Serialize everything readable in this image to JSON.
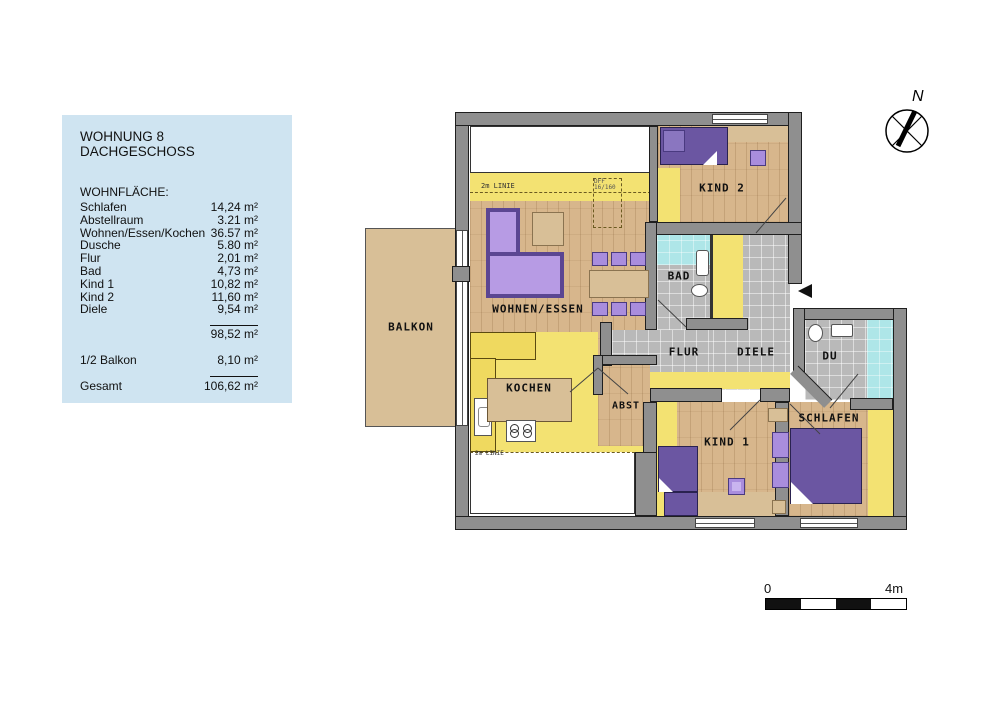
{
  "legend": {
    "title_line1": "WOHNUNG 8",
    "title_line2": "DACHGESCHOSS",
    "section_header": "WOHNFLÄCHE:",
    "rows": [
      {
        "label": "Schlafen",
        "value": "14,24 m²"
      },
      {
        "label": "Abstellraum",
        "value": "3.21 m²"
      },
      {
        "label": "Wohnen/Essen/Kochen",
        "value": "36.57 m²"
      },
      {
        "label": "Dusche",
        "value": "5.80 m²"
      },
      {
        "label": "Flur",
        "value": "2,01 m²"
      },
      {
        "label": "Bad",
        "value": "4,73 m²"
      },
      {
        "label": "Kind 1",
        "value": "10,82 m²"
      },
      {
        "label": "Kind 2",
        "value": "11,60 m²"
      },
      {
        "label": "Diele",
        "value": "9,54 m²"
      }
    ],
    "subtotal_value": "98,52 m²",
    "balkon_label": "1/2 Balkon",
    "balkon_value": "8,10 m²",
    "total_label": "Gesamt",
    "total_value": "106,62 m²"
  },
  "plan": {
    "rooms": [
      {
        "label": "BALKON"
      },
      {
        "label": "WOHNEN/ESSEN"
      },
      {
        "label": "KOCHEN"
      },
      {
        "label": "ABST"
      },
      {
        "label": "BAD"
      },
      {
        "label": "FLUR"
      },
      {
        "label": "DIELE"
      },
      {
        "label": "DU"
      },
      {
        "label": "KIND 1"
      },
      {
        "label": "KIND 2"
      },
      {
        "label": "SCHLAFEN"
      }
    ],
    "annotations": {
      "line_top": "2m LINIE",
      "line_bottom": "2m LINIE",
      "roof_window": "DFF 16/160"
    },
    "compass_label": "N",
    "scalebar": {
      "start": "0",
      "end": "4m"
    }
  },
  "colors": {
    "legend_bg": "#cfe4f1",
    "wall": "#8f8f8f",
    "wood_floor": "#d7b68c",
    "under_2m_yellow": "#f3e272",
    "hall_tile": "#b9b9b9",
    "wet_cyan": "#aee6e8",
    "furniture_dark_purple": "#6b56a2",
    "furniture_light_purple": "#a98ddd",
    "balcony_tan": "#d8bf97"
  }
}
